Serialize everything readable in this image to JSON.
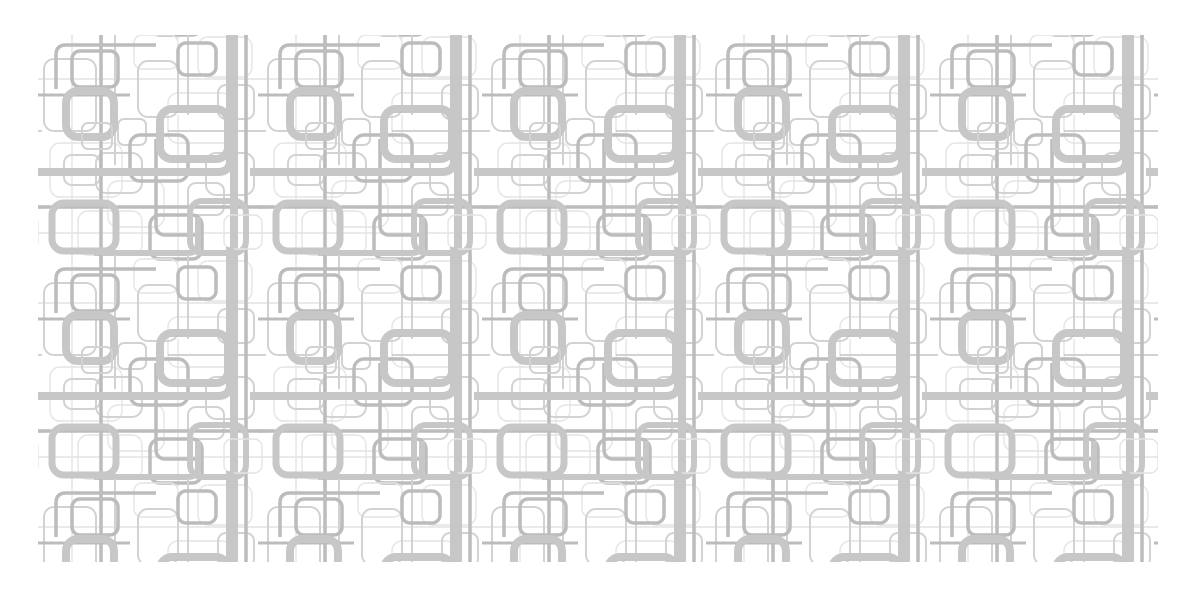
{
  "canvas": {
    "width": 1200,
    "height": 600,
    "background": "#ffffff"
  },
  "artwork": {
    "kind": "seamless-rounded-rectangle-circuit-pattern",
    "left": 38,
    "top": 35,
    "width": 1120,
    "height": 527,
    "tile_size": 224,
    "palette": {
      "background": "#ffffff",
      "thick": "#c7c7c7",
      "medium": "#bcbcbc",
      "thin": "#d2d2d2",
      "faint": "#e4e4e4"
    },
    "shapes": [
      {
        "t": "r",
        "x": 12,
        "y": 108,
        "w": 72,
        "h": 54,
        "rx": 10,
        "c": "faint",
        "sw": 1.4
      },
      {
        "t": "r",
        "x": 130,
        "y": 58,
        "w": 64,
        "h": 50,
        "rx": 10,
        "c": "faint",
        "sw": 1.4
      },
      {
        "t": "r",
        "x": 40,
        "y": 176,
        "w": 64,
        "h": 44,
        "rx": 10,
        "c": "faint",
        "sw": 1.4
      },
      {
        "t": "r",
        "x": 160,
        "y": 2,
        "w": 54,
        "h": 40,
        "rx": 10,
        "c": "faint",
        "sw": 1.4
      },
      {
        "t": "l",
        "x1": -4,
        "y1": 44,
        "x2": 228,
        "y2": 44,
        "c": "faint",
        "sw": 1.4
      },
      {
        "t": "l",
        "x1": 140,
        "y1": 80,
        "x2": 140,
        "y2": 228,
        "c": "faint",
        "sw": 1.4
      },
      {
        "t": "r",
        "x": 70,
        "y": 146,
        "w": 56,
        "h": 46,
        "rx": 10,
        "c": "faint",
        "sw": 1.4
      },
      {
        "t": "l",
        "x1": 34,
        "y1": -4,
        "x2": 34,
        "y2": 228,
        "c": "faint",
        "sw": 1.4
      },
      {
        "t": "l",
        "x1": -4,
        "y1": 198,
        "x2": 228,
        "y2": 198,
        "c": "faint",
        "sw": 1.4
      },
      {
        "t": "r",
        "x": 96,
        "y": 0,
        "w": 44,
        "h": 34,
        "rx": 8,
        "c": "faint",
        "sw": 1.4
      },
      {
        "t": "r",
        "x": 6,
        "y": 24,
        "w": 52,
        "h": 72,
        "rx": 10,
        "c": "thin",
        "sw": 2
      },
      {
        "t": "r",
        "x": 80,
        "y": 84,
        "w": 28,
        "h": 26,
        "rx": 6,
        "c": "thin",
        "sw": 2
      },
      {
        "t": "r",
        "x": 150,
        "y": 148,
        "w": 36,
        "h": 32,
        "rx": 8,
        "c": "thin",
        "sw": 2
      },
      {
        "t": "r",
        "x": 58,
        "y": 118,
        "w": 46,
        "h": 40,
        "rx": 10,
        "c": "thin",
        "sw": 2
      },
      {
        "t": "r",
        "x": 168,
        "y": 118,
        "w": 48,
        "h": 42,
        "rx": 10,
        "c": "thin",
        "sw": 2
      },
      {
        "t": "r",
        "x": 100,
        "y": 26,
        "w": 40,
        "h": 56,
        "rx": 10,
        "c": "thin",
        "sw": 2
      },
      {
        "t": "l",
        "x1": 150,
        "y1": -4,
        "x2": 150,
        "y2": 80,
        "c": "thin",
        "sw": 2
      },
      {
        "t": "l",
        "x1": 130,
        "y1": 96,
        "x2": 228,
        "y2": 96,
        "c": "thin",
        "sw": 2
      },
      {
        "t": "r",
        "x": 26,
        "y": 120,
        "w": 36,
        "h": 30,
        "rx": 8,
        "c": "thin",
        "sw": 2
      },
      {
        "t": "r",
        "x": 180,
        "y": 50,
        "w": 36,
        "h": 34,
        "rx": 8,
        "c": "thin",
        "sw": 2
      },
      {
        "t": "l",
        "x1": 77,
        "y1": -4,
        "x2": 77,
        "y2": 130,
        "c": "thin",
        "sw": 2
      },
      {
        "t": "l",
        "x1": 63,
        "y1": -4,
        "x2": 63,
        "y2": 228,
        "c": "medium",
        "sw": 3.5
      },
      {
        "t": "p",
        "d": "M 118 10 H 28 Q 18 10 18 20 V 54",
        "c": "medium",
        "sw": 3.5
      },
      {
        "t": "r",
        "x": 34,
        "y": 16,
        "w": 46,
        "h": 36,
        "rx": 8,
        "c": "medium",
        "sw": 3.5
      },
      {
        "t": "r",
        "x": 92,
        "y": 100,
        "w": 58,
        "h": 46,
        "rx": 10,
        "c": "medium",
        "sw": 3.5
      },
      {
        "t": "r",
        "x": 140,
        "y": 8,
        "w": 38,
        "h": 32,
        "rx": 8,
        "c": "medium",
        "sw": 3.5
      },
      {
        "t": "l",
        "x1": -4,
        "y1": 172,
        "x2": 228,
        "y2": 172,
        "c": "medium",
        "sw": 3.5
      },
      {
        "t": "l",
        "x1": 208,
        "y1": -4,
        "x2": 208,
        "y2": 228,
        "c": "medium",
        "sw": 3.5
      },
      {
        "t": "r",
        "x": 112,
        "y": 180,
        "w": 52,
        "h": 44,
        "rx": 10,
        "c": "medium",
        "sw": 3.5
      },
      {
        "t": "p",
        "d": "M 118 104 V 190 Q 118 200 128 200 H 160",
        "c": "medium",
        "sw": 3.5
      },
      {
        "t": "l",
        "x1": -4,
        "y1": 60,
        "x2": 92,
        "y2": 60,
        "c": "medium",
        "sw": 3
      },
      {
        "t": "p",
        "d": "M -12 137 H 180 Q 192 137 192 125 V -12",
        "c": "thick",
        "sw": 8
      },
      {
        "t": "r",
        "x": 28,
        "y": 56,
        "w": 48,
        "h": 46,
        "rx": 12,
        "c": "thick",
        "sw": 8
      },
      {
        "t": "r",
        "x": 122,
        "y": 74,
        "w": 68,
        "h": 50,
        "rx": 12,
        "c": "thick",
        "sw": 8
      },
      {
        "t": "l",
        "x1": 196,
        "y1": -4,
        "x2": 196,
        "y2": 228,
        "c": "thick",
        "sw": 8
      },
      {
        "t": "r",
        "x": 14,
        "y": 168,
        "w": 64,
        "h": 48,
        "rx": 12,
        "c": "thick",
        "sw": 7
      },
      {
        "t": "r",
        "x": 152,
        "y": 166,
        "w": 56,
        "h": 52,
        "rx": 12,
        "c": "thick",
        "sw": 6
      },
      {
        "t": "p",
        "d": "M 56 218 H 150 Q 160 218 160 208 V 182",
        "c": "thick",
        "sw": 6
      },
      {
        "t": "r",
        "x": 44,
        "y": 88,
        "w": 30,
        "h": 26,
        "rx": 6,
        "c": "thin",
        "sw": 2
      },
      {
        "t": "r",
        "x": 186,
        "y": 180,
        "w": 38,
        "h": 34,
        "rx": 8,
        "c": "faint",
        "sw": 1.4
      }
    ]
  }
}
